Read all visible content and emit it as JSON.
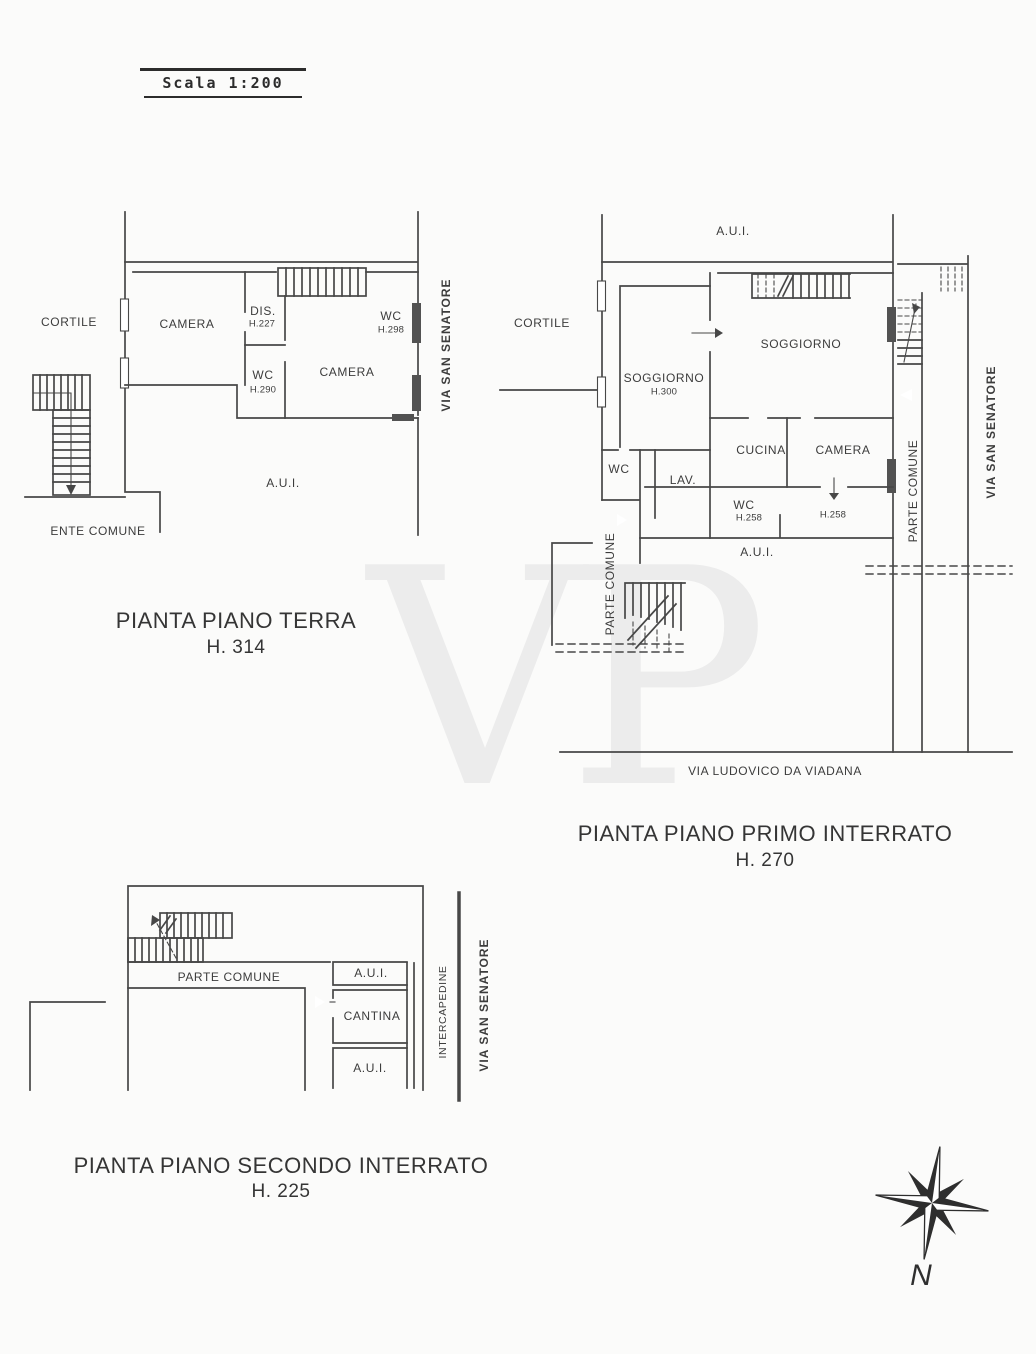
{
  "scale_bar": {
    "label": "Scala 1:200"
  },
  "watermark": {
    "text": "VP"
  },
  "compass": {
    "north_label": "N"
  },
  "colors": {
    "ink": "#474747",
    "paper": "#fbfbfa",
    "watermark": "#ececec"
  },
  "plans": {
    "terra": {
      "title": "PIANTA PIANO TERRA",
      "height_label": "H. 314",
      "labels": {
        "cortile": "CORTILE",
        "camera_left": "CAMERA",
        "dis": "DIS.",
        "dis_height": "H.227",
        "wc_top": "WC",
        "wc_top_height": "H.298",
        "wc_mid": "WC",
        "wc_mid_height": "H.290",
        "camera_right": "CAMERA",
        "aui": "A.U.I.",
        "ente_comune": "ENTE COMUNE",
        "via_san_senatore": "VIA SAN SENATORE"
      }
    },
    "primo_interrato": {
      "title": "PIANTA PIANO PRIMO INTERRATO",
      "height_label": "H. 270",
      "labels": {
        "aui_top": "A.U.I.",
        "cortile": "CORTILE",
        "soggiorno_left": "SOGGIORNO",
        "soggiorno_left_height": "H.300",
        "soggiorno_right": "SOGGIORNO",
        "cucina": "CUCINA",
        "camera": "CAMERA",
        "wc_left": "WC",
        "lav": "LAV.",
        "wc_mid": "WC",
        "wc_mid_height": "H.258",
        "camera_height": "H.258",
        "aui_bottom": "A.U.I.",
        "parte_comune_left": "PARTE COMUNE",
        "parte_comune_right": "PARTE COMUNE",
        "via_san_senatore": "VIA SAN SENATORE",
        "via_ludovico": "VIA LUDOVICO DA VIADANA"
      }
    },
    "secondo_interrato": {
      "title": "PIANTA PIANO SECONDO INTERRATO",
      "height_label": "H. 225",
      "labels": {
        "parte_comune": "PARTE COMUNE",
        "aui_top": "A.U.I.",
        "cantina": "CANTINA",
        "aui_bottom": "A.U.I.",
        "intercapedine": "INTERCAPEDINE",
        "via_san_senatore": "VIA SAN SENATORE"
      }
    }
  }
}
